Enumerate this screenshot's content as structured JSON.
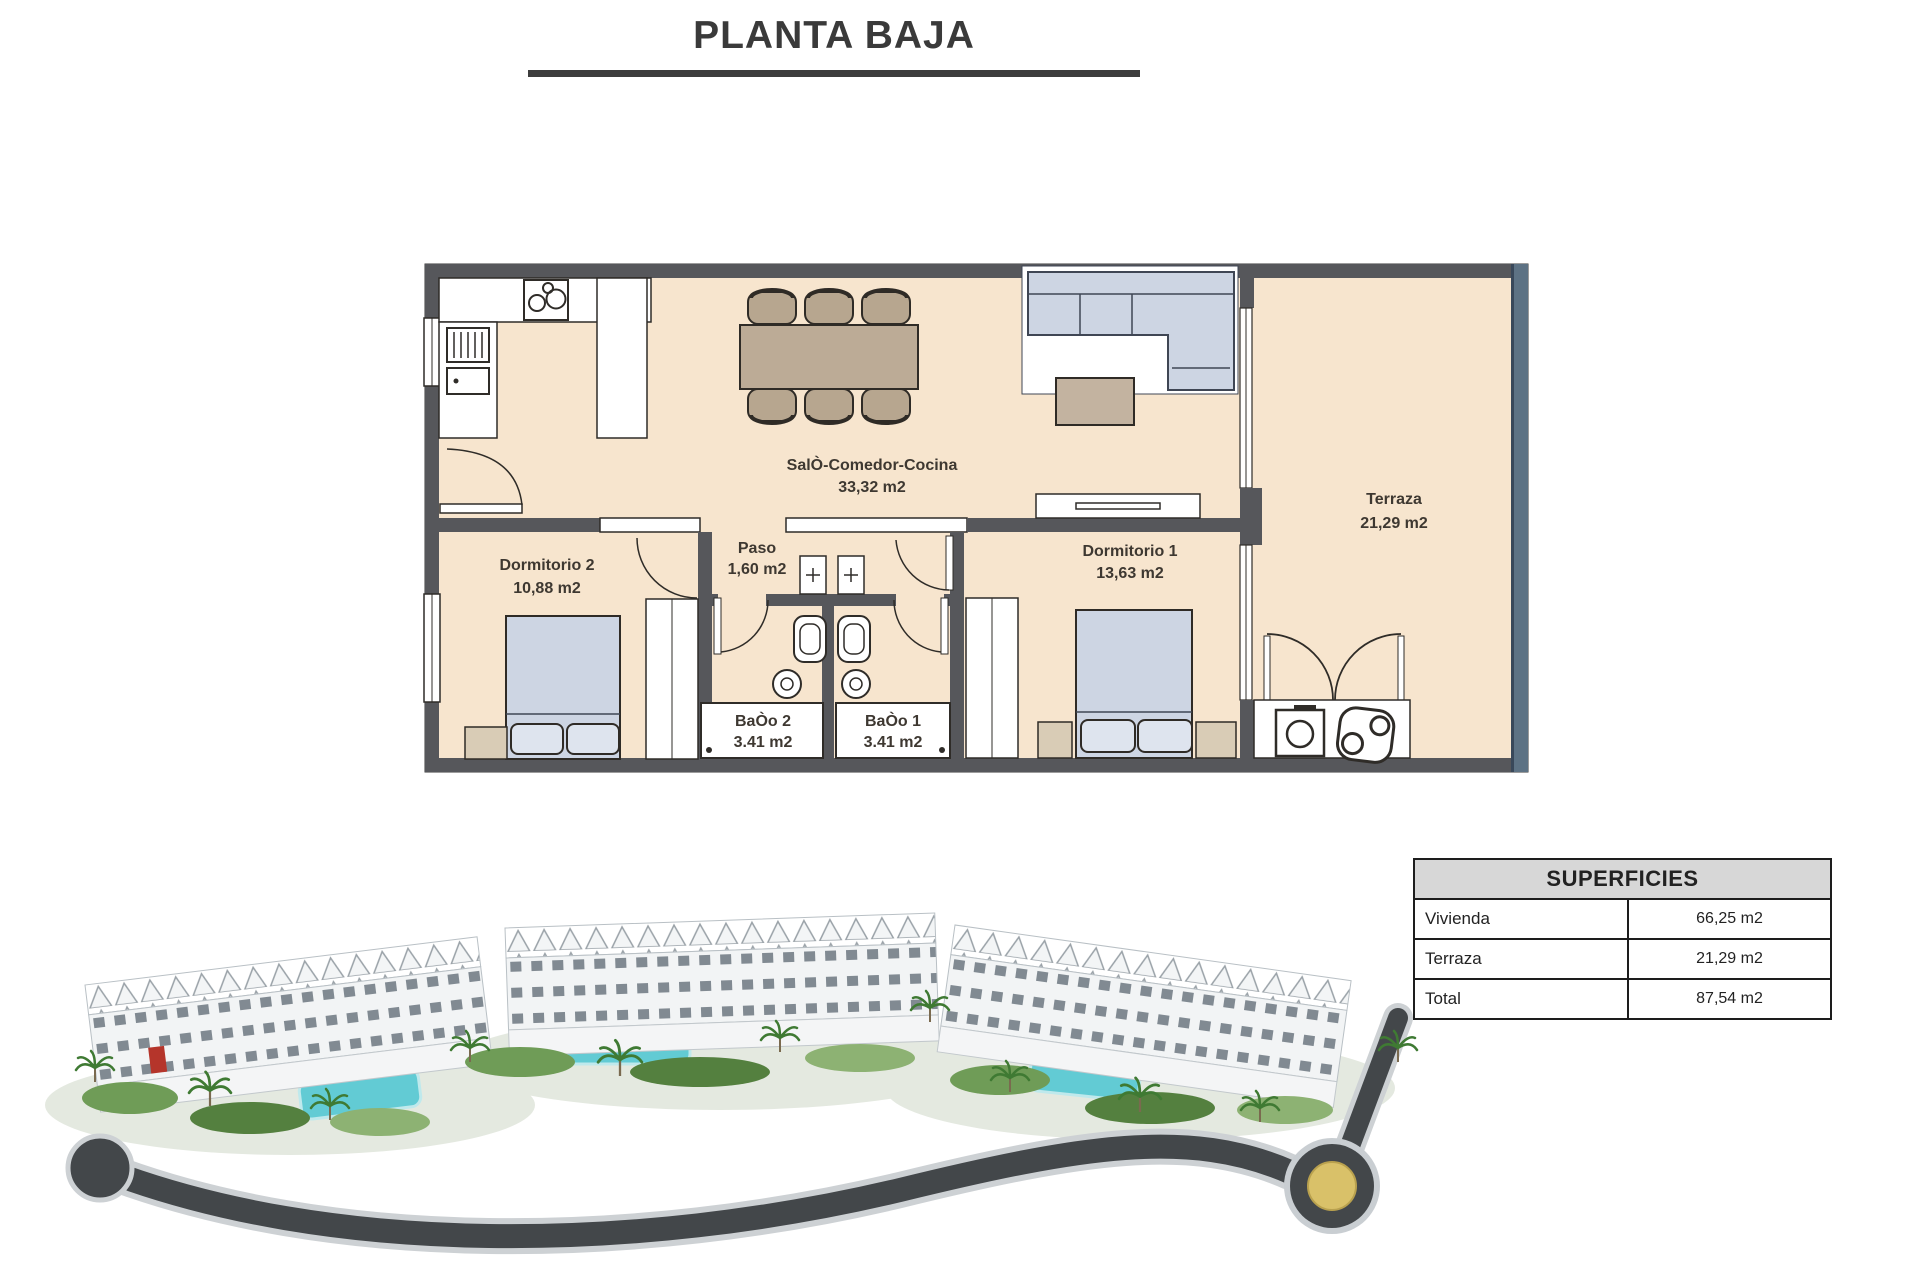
{
  "page": {
    "title": "PLANTA BAJA"
  },
  "floor_plan": {
    "rooms": [
      {
        "name": "SalÒ-Comedor-Cocina",
        "area": "33,32 m2"
      },
      {
        "name": "Terraza",
        "area": "21,29 m2"
      },
      {
        "name": "Dormitorio 2",
        "area": "10,88 m2"
      },
      {
        "name": "Paso",
        "area": "1,60 m2"
      },
      {
        "name": "Dormitorio 1",
        "area": "13,63 m2"
      },
      {
        "name": "BaÒo 2",
        "area": "3.41 m2"
      },
      {
        "name": "BaÒo 1",
        "area": "3.41 m2"
      }
    ]
  },
  "superficies": {
    "title": "SUPERFICIES",
    "rows": [
      {
        "label": "Vivienda",
        "value": "66,25 m2"
      },
      {
        "label": "Terraza",
        "value": "21,29 m2"
      },
      {
        "label": "Total",
        "value": "87,54 m2"
      }
    ]
  },
  "colors": {
    "plan_floor": "#f7e5ce",
    "plan_wall": "#56575b",
    "terrace_wall": "#5d7284",
    "furniture_blue": "#cdd5e3",
    "furniture_tan": "#bcab96",
    "table_header_bg": "#d7d7d7",
    "pool": "#62cbd4",
    "road": "#43474a",
    "roundabout_center": "#d9c169"
  }
}
